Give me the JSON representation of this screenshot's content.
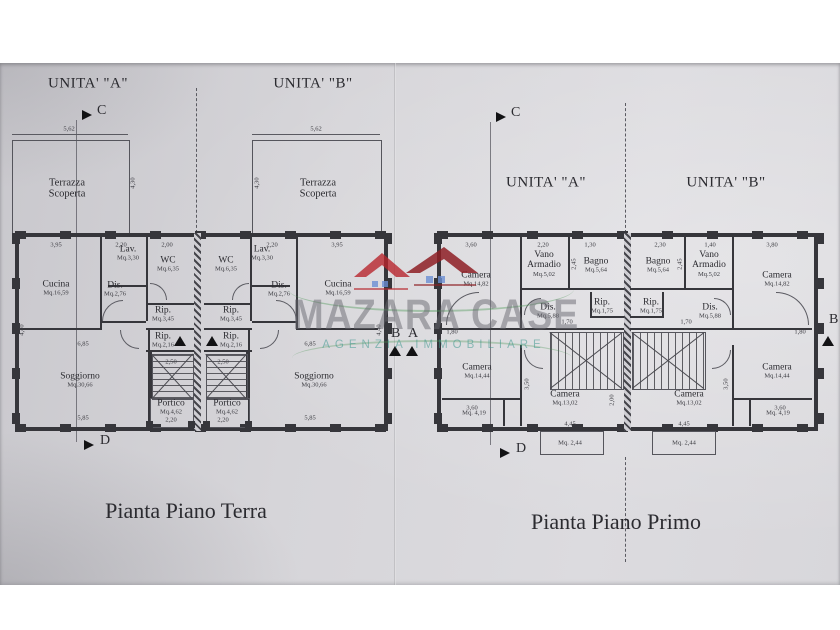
{
  "watermark": {
    "brand": "MAZARA CASE",
    "tagline": "AGENZIA IMMOBILIARE",
    "brand_color": "rgba(104,103,112,0.50)",
    "tagline_color": "rgba(62,152,142,0.55)",
    "roof_color": "#b8262d",
    "roof_dark": "#8e1f24",
    "window_color": "#6b8fd3",
    "swoosh_color": "#4a9a55"
  },
  "terra": {
    "title": "Pianta Piano Terra",
    "unit_a": "UNITA' \"A\"",
    "unit_b": "UNITA' \"B\"",
    "sections": {
      "c": "C",
      "d": "D",
      "b": "B",
      "a": "A"
    },
    "rooms": [
      {
        "name": "Terrazza Scoperta",
        "area": ""
      },
      {
        "name": "Terrazza Scoperta",
        "area": ""
      },
      {
        "name": "Cucina",
        "area": "Mq.16,59"
      },
      {
        "name": "Lav.",
        "area": "Mq.3,30"
      },
      {
        "name": "WC",
        "area": "Mq.6,35"
      },
      {
        "name": "Dis.",
        "area": "Mq.2,76"
      },
      {
        "name": "Rip.",
        "area": "Mq.3,45"
      },
      {
        "name": "Rip.",
        "area": "Mq.2,16"
      },
      {
        "name": "Soggiorno",
        "area": "Mq.30,66"
      },
      {
        "name": "Portico",
        "area": "Mq.4,62"
      },
      {
        "name": "Cucina",
        "area": "Mq.16,59"
      },
      {
        "name": "Lav.",
        "area": "Mq.3,30"
      },
      {
        "name": "WC",
        "area": "Mq.6,35"
      },
      {
        "name": "Dis.",
        "area": "Mq.2,76"
      },
      {
        "name": "Rip.",
        "area": "Mq.3,45"
      },
      {
        "name": "Rip.",
        "area": "Mq.2,16"
      },
      {
        "name": "Soggiorno",
        "area": "Mq.30,66"
      },
      {
        "name": "Portico",
        "area": "Mq.4,62"
      }
    ],
    "dims": [
      "5,62",
      "5,62",
      "4,30",
      "4,30",
      "3,95",
      "2,20",
      "2,00",
      "2,20",
      "3,95",
      "6,85",
      "6,85",
      "4,40",
      "4,40",
      "5,85",
      "5,85",
      "2,50",
      "2,50",
      "2,20",
      "2,20"
    ]
  },
  "primo": {
    "title": "Pianta Piano Primo",
    "unit_a": "UNITA' \"A\"",
    "unit_b": "UNITA' \"B\"",
    "sections": {
      "c": "C",
      "d": "D",
      "b": "B"
    },
    "rooms": [
      {
        "name": "Camera",
        "area": "Mq.14,82"
      },
      {
        "name": "Vano Armadio",
        "area": "Mq.5,02"
      },
      {
        "name": "Bagno",
        "area": "Mq.5,64"
      },
      {
        "name": "Dis.",
        "area": "Mq.5,88"
      },
      {
        "name": "Rip.",
        "area": "Mq.1,75"
      },
      {
        "name": "Camera",
        "area": "Mq.14,44"
      },
      {
        "name": "Camera",
        "area": "Mq.13,02"
      },
      {
        "name": "",
        "area": "Mq. 4,19"
      },
      {
        "name": "",
        "area": "Mq. 2,44"
      },
      {
        "name": "Bagno",
        "area": "Mq.5,64"
      },
      {
        "name": "Vano Armadio",
        "area": "Mq.5,02"
      },
      {
        "name": "Camera",
        "area": "Mq.14,82"
      },
      {
        "name": "Rip.",
        "area": "Mq.1,75"
      },
      {
        "name": "Dis.",
        "area": "Mq.5,88"
      },
      {
        "name": "Camera",
        "area": "Mq.13,02"
      },
      {
        "name": "Camera",
        "area": "Mq.14,44"
      },
      {
        "name": "",
        "area": "Mq. 2,44"
      },
      {
        "name": "",
        "area": "Mq. 4,19"
      }
    ],
    "dims": [
      "3,60",
      "2,20",
      "1,30",
      "2,30",
      "1,40",
      "3,80",
      "2,45",
      "2,45",
      "1,70",
      "1,70",
      "1,80",
      "1,80",
      "3,50",
      "3,50",
      "4,45",
      "4,45",
      "3,60",
      "3,60",
      "2,00"
    ]
  }
}
